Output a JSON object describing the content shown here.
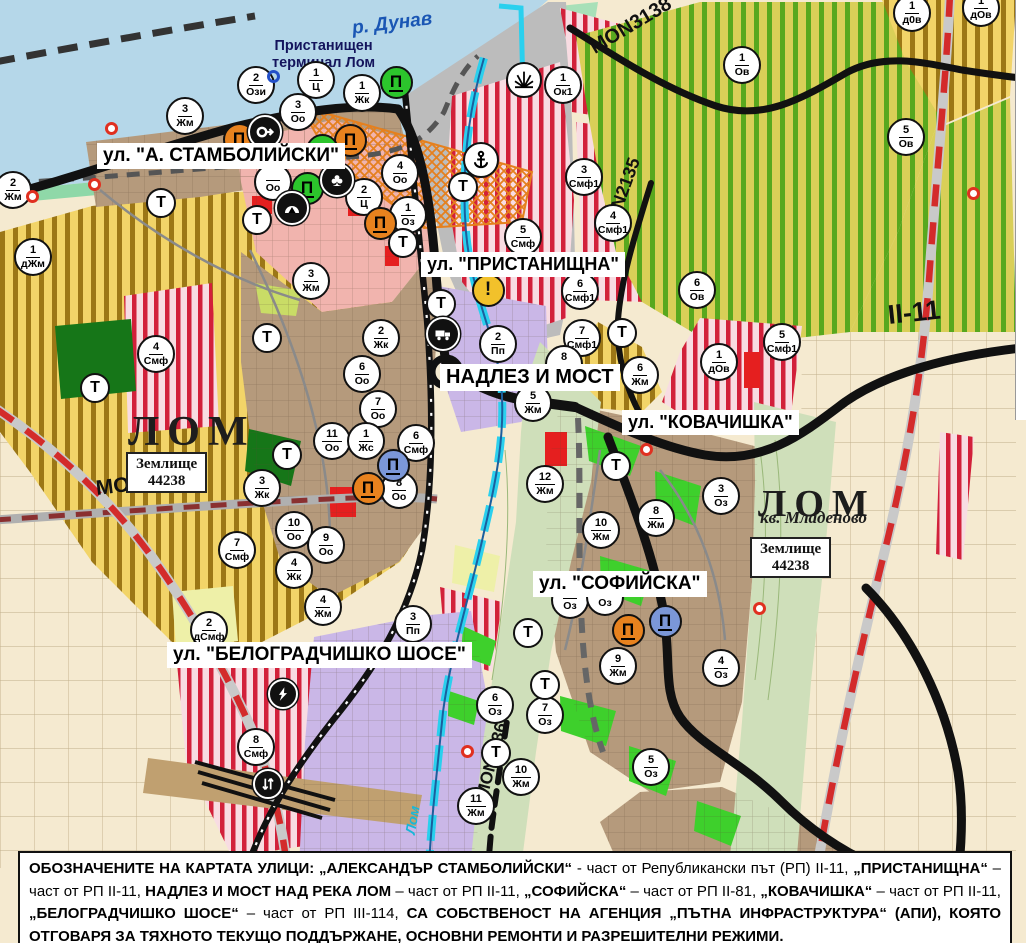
{
  "map": {
    "water_label": "р. Дунав",
    "port_terminal_label": "Пристанищен\nтерминал Лом",
    "river_label": "Лом",
    "transport_label": "Т",
    "street_labels": [
      {
        "text": "ул. \"А. СТАМБОЛИЙСКИ\"",
        "x": 97,
        "y": 143,
        "size": 19
      },
      {
        "text": "ул. \"ПРИСТАНИЩНА\"",
        "x": 421,
        "y": 252,
        "size": 18
      },
      {
        "text": "НАДЛЕЗ И МОСТ",
        "x": 440,
        "y": 364,
        "size": 20
      },
      {
        "text": "ул. \"КОВАЧИШКА\"",
        "x": 622,
        "y": 410,
        "size": 18
      },
      {
        "text": "ул. \"СОФИЙСКА\"",
        "x": 533,
        "y": 571,
        "size": 19
      },
      {
        "text": "ул. \"БЕЛОГРАДЧИШКО ШОСЕ\"",
        "x": 167,
        "y": 642,
        "size": 19
      }
    ],
    "place_labels": [
      {
        "text": "ЛОМ",
        "x": 128,
        "y": 408,
        "size": 42
      },
      {
        "text": "ЛОМ",
        "x": 758,
        "y": 482,
        "size": 38
      }
    ],
    "quarter_label": {
      "text": "кв. Младеново",
      "x": 760,
      "y": 508,
      "size": 17
    },
    "land_parcels": [
      {
        "line1": "Землище",
        "line2": "44238",
        "x": 126,
        "y": 452
      },
      {
        "line1": "Землище",
        "line2": "44238",
        "x": 750,
        "y": 537
      }
    ],
    "road_labels": [
      {
        "text": "MON3138",
        "x": 592,
        "y": 38,
        "rot": -31,
        "size": 20
      },
      {
        "text": "MON2135",
        "x": 607,
        "y": 225,
        "rot": -70,
        "size": 18
      },
      {
        "text": "II-11",
        "x": 888,
        "y": 300,
        "rot": -6,
        "size": 27
      },
      {
        "text": "MON3139",
        "x": 96,
        "y": 477,
        "rot": -7,
        "size": 21
      },
      {
        "text": "MON2136",
        "x": 482,
        "y": 788,
        "rot": -75,
        "size": 17
      }
    ],
    "zone_markers": [
      {
        "n": "2",
        "c": "Жм",
        "x": 13,
        "y": 190
      },
      {
        "n": "1",
        "c": "дЖм",
        "x": 33,
        "y": 257
      },
      {
        "n": "3",
        "c": "Жм",
        "x": 185,
        "y": 116
      },
      {
        "n": "2",
        "c": "Ози",
        "x": 256,
        "y": 85
      },
      {
        "n": "1",
        "c": "Ц",
        "x": 316,
        "y": 80
      },
      {
        "n": "3",
        "c": "Оо",
        "x": 298,
        "y": 112
      },
      {
        "n": "1",
        "c": "Жк",
        "x": 362,
        "y": 93
      },
      {
        "n": "",
        "c": "Оо",
        "x": 273,
        "y": 182
      },
      {
        "n": "4",
        "c": "Оо",
        "x": 400,
        "y": 173
      },
      {
        "n": "2",
        "c": "Ц",
        "x": 364,
        "y": 197
      },
      {
        "n": "1",
        "c": "Оз",
        "x": 408,
        "y": 215
      },
      {
        "n": "3",
        "c": "Жм",
        "x": 311,
        "y": 281
      },
      {
        "n": "1",
        "c": "Ок1",
        "x": 563,
        "y": 85
      },
      {
        "n": "3",
        "c": "Смф1",
        "x": 584,
        "y": 177
      },
      {
        "n": "5",
        "c": "Смф",
        "x": 523,
        "y": 237
      },
      {
        "n": "4",
        "c": "Смф1",
        "x": 613,
        "y": 223
      },
      {
        "n": "6",
        "c": "Смф1",
        "x": 580,
        "y": 291
      },
      {
        "n": "7",
        "c": "Смф1",
        "x": 582,
        "y": 338
      },
      {
        "n": "1",
        "c": "Ов",
        "x": 742,
        "y": 65
      },
      {
        "n": "1",
        "c": "д0в",
        "x": 912,
        "y": 13
      },
      {
        "n": "1",
        "c": "дОв",
        "x": 981,
        "y": 8
      },
      {
        "n": "5",
        "c": "Ов",
        "x": 906,
        "y": 137
      },
      {
        "n": "6",
        "c": "Ов",
        "x": 697,
        "y": 290
      },
      {
        "n": "1",
        "c": "дОв",
        "x": 719,
        "y": 362
      },
      {
        "n": "5",
        "c": "Смф1",
        "x": 782,
        "y": 342
      },
      {
        "n": "6",
        "c": "Жм",
        "x": 640,
        "y": 375
      },
      {
        "n": "2",
        "c": "Жк",
        "x": 381,
        "y": 338
      },
      {
        "n": "6",
        "c": "Оо",
        "x": 362,
        "y": 374
      },
      {
        "n": "7",
        "c": "Оо",
        "x": 378,
        "y": 409
      },
      {
        "n": "2",
        "c": "Пп",
        "x": 498,
        "y": 344
      },
      {
        "n": "8",
        "c": "Жм",
        "x": 564,
        "y": 364
      },
      {
        "n": "5",
        "c": "Жм",
        "x": 533,
        "y": 403
      },
      {
        "n": "12",
        "c": "Жм",
        "x": 545,
        "y": 484
      },
      {
        "n": "11",
        "c": "Оо",
        "x": 332,
        "y": 441
      },
      {
        "n": "1",
        "c": "Жс",
        "x": 366,
        "y": 441
      },
      {
        "n": "6",
        "c": "Смф",
        "x": 416,
        "y": 443
      },
      {
        "n": "8",
        "c": "Оо",
        "x": 399,
        "y": 490
      },
      {
        "n": "3",
        "c": "Жк",
        "x": 262,
        "y": 488
      },
      {
        "n": "10",
        "c": "Оо",
        "x": 294,
        "y": 530
      },
      {
        "n": "9",
        "c": "Оо",
        "x": 326,
        "y": 545
      },
      {
        "n": "7",
        "c": "Смф",
        "x": 237,
        "y": 550
      },
      {
        "n": "4",
        "c": "Жк",
        "x": 294,
        "y": 570
      },
      {
        "n": "4",
        "c": "Жм",
        "x": 323,
        "y": 607
      },
      {
        "n": "4",
        "c": "Смф",
        "x": 156,
        "y": 354
      },
      {
        "n": "3",
        "c": "Оз",
        "x": 721,
        "y": 496
      },
      {
        "n": "8",
        "c": "Жм",
        "x": 656,
        "y": 518
      },
      {
        "n": "10",
        "c": "Жм",
        "x": 601,
        "y": 530
      },
      {
        "n": "",
        "c": "Оз",
        "x": 570,
        "y": 600
      },
      {
        "n": "",
        "c": "Оз",
        "x": 605,
        "y": 597
      },
      {
        "n": "9",
        "c": "Жм",
        "x": 618,
        "y": 666
      },
      {
        "n": "4",
        "c": "Оз",
        "x": 721,
        "y": 668
      },
      {
        "n": "6",
        "c": "Оз",
        "x": 495,
        "y": 705
      },
      {
        "n": "7",
        "c": "Оз",
        "x": 545,
        "y": 715
      },
      {
        "n": "5",
        "c": "Оз",
        "x": 651,
        "y": 767
      },
      {
        "n": "10",
        "c": "Жм",
        "x": 521,
        "y": 777
      },
      {
        "n": "11",
        "c": "Жм",
        "x": 476,
        "y": 806
      },
      {
        "n": "2",
        "c": "дСмф",
        "x": 209,
        "y": 630
      },
      {
        "n": "3",
        "c": "Пп",
        "x": 413,
        "y": 624
      },
      {
        "n": "8",
        "c": "Смф",
        "x": 256,
        "y": 747
      }
    ],
    "transport_markers": [
      {
        "x": 161,
        "y": 203
      },
      {
        "x": 257,
        "y": 220
      },
      {
        "x": 403,
        "y": 243
      },
      {
        "x": 463,
        "y": 187
      },
      {
        "x": 441,
        "y": 304
      },
      {
        "x": 287,
        "y": 455
      },
      {
        "x": 95,
        "y": 388
      },
      {
        "x": 267,
        "y": 338
      },
      {
        "x": 622,
        "y": 333
      },
      {
        "x": 616,
        "y": 466
      },
      {
        "x": 528,
        "y": 633
      },
      {
        "x": 545,
        "y": 685
      },
      {
        "x": 496,
        "y": 753
      }
    ],
    "poi_icons": [
      {
        "t": "monument-orange",
        "x": 239,
        "y": 139
      },
      {
        "t": "monument-orange",
        "x": 350,
        "y": 140
      },
      {
        "t": "monument-orange",
        "x": 380,
        "y": 223
      },
      {
        "t": "monument-orange",
        "x": 368,
        "y": 488
      },
      {
        "t": "monument-orange",
        "x": 628,
        "y": 630
      },
      {
        "t": "monument-green",
        "x": 396,
        "y": 82
      },
      {
        "t": "monument-green",
        "x": 322,
        "y": 150
      },
      {
        "t": "monument-green",
        "x": 307,
        "y": 188
      },
      {
        "t": "monument-blue",
        "x": 393,
        "y": 465
      },
      {
        "t": "monument-blue",
        "x": 665,
        "y": 621
      },
      {
        "t": "key",
        "x": 265,
        "y": 132
      },
      {
        "t": "club",
        "x": 337,
        "y": 180
      },
      {
        "t": "tunnel",
        "x": 292,
        "y": 208
      },
      {
        "t": "anchor",
        "x": 481,
        "y": 160
      },
      {
        "t": "fan",
        "x": 524,
        "y": 80
      },
      {
        "t": "warning",
        "x": 488,
        "y": 290
      },
      {
        "t": "truck",
        "x": 443,
        "y": 334
      },
      {
        "t": "lightning",
        "x": 283,
        "y": 694
      },
      {
        "t": "arrows",
        "x": 268,
        "y": 784
      },
      {
        "t": "blue-ring",
        "x": 283,
        "y": 86
      },
      {
        "t": "red-dot",
        "x": 121,
        "y": 138
      },
      {
        "t": "red-dot",
        "x": 104,
        "y": 194
      },
      {
        "t": "red-dot",
        "x": 42,
        "y": 206
      },
      {
        "t": "red-dot",
        "x": 656,
        "y": 459
      },
      {
        "t": "red-dot",
        "x": 477,
        "y": 761
      },
      {
        "t": "red-dot",
        "x": 769,
        "y": 618
      },
      {
        "t": "red-dot",
        "x": 983,
        "y": 203
      }
    ]
  },
  "legend_bar": {
    "segments": [
      {
        "text": "ОБОЗНАЧЕНИТЕ НА КАРТАТА УЛИЦИ: „АЛЕКСАНДЪР СТАМБОЛИЙСКИ“",
        "bold": true
      },
      {
        "text": " - част от Републикански път (РП) II-11, ",
        "bold": false
      },
      {
        "text": "„ПРИСТАНИЩНА“",
        "bold": true
      },
      {
        "text": " – част от РП II-11, ",
        "bold": false
      },
      {
        "text": "НАДЛЕЗ И МОСТ НАД РЕКА ЛОМ",
        "bold": true
      },
      {
        "text": " – част от РП II-11, ",
        "bold": false
      },
      {
        "text": "„СОФИЙСКА“",
        "bold": true
      },
      {
        "text": " – част от РП II-81, ",
        "bold": false
      },
      {
        "text": "„КОВАЧИШКА“",
        "bold": true
      },
      {
        "text": " – част от РП II-11, ",
        "bold": false
      },
      {
        "text": "„БЕЛОГРАДЧИШКО ШОСЕ“",
        "bold": true
      },
      {
        "text": " – част от РП III-114, ",
        "bold": false
      },
      {
        "text": "СА СОБСТВЕНОСТ НА АГЕНЦИЯ „ПЪТНА ИНФРАСТРУКТУРА“ (АПИ), КОЯТО ОТГОВАРЯ ЗА ТЯХНОТО ТЕКУЩО ПОДДЪРЖАНЕ, ОСНОВНИ РЕМОНТИ И РАЗРЕШИТЕЛНИ РЕЖИМИ.",
        "bold": true
      }
    ]
  },
  "colors": {
    "water": "#b5d7e9",
    "cream": "#f5ead0",
    "gold_bg": "#f2d468",
    "gold_stripe": "#9c7716",
    "green_bg": "#d9cf58",
    "green_stripe": "#58a81e",
    "red_bg": "#f8dce2",
    "red_stripe": "#d2203a",
    "urban_brown": "#b59a7c",
    "purple": "#cab7e7",
    "pink_center": "#f1b4ae",
    "port_grey": "#bcbcbc",
    "valley_green": "#cfdfba",
    "park_dark": "#167618",
    "park_bright": "#3ed02c",
    "road_black": "#111111",
    "road_red_dash": "#d32b2b",
    "river_cyan": "#2ad0ee",
    "label_blue": "#1a56b4",
    "warning_yellow": "#f2c12b",
    "monument_orange": "#e8821e",
    "monument_green": "#2cc52c",
    "monument_blue": "#7b97d8"
  }
}
